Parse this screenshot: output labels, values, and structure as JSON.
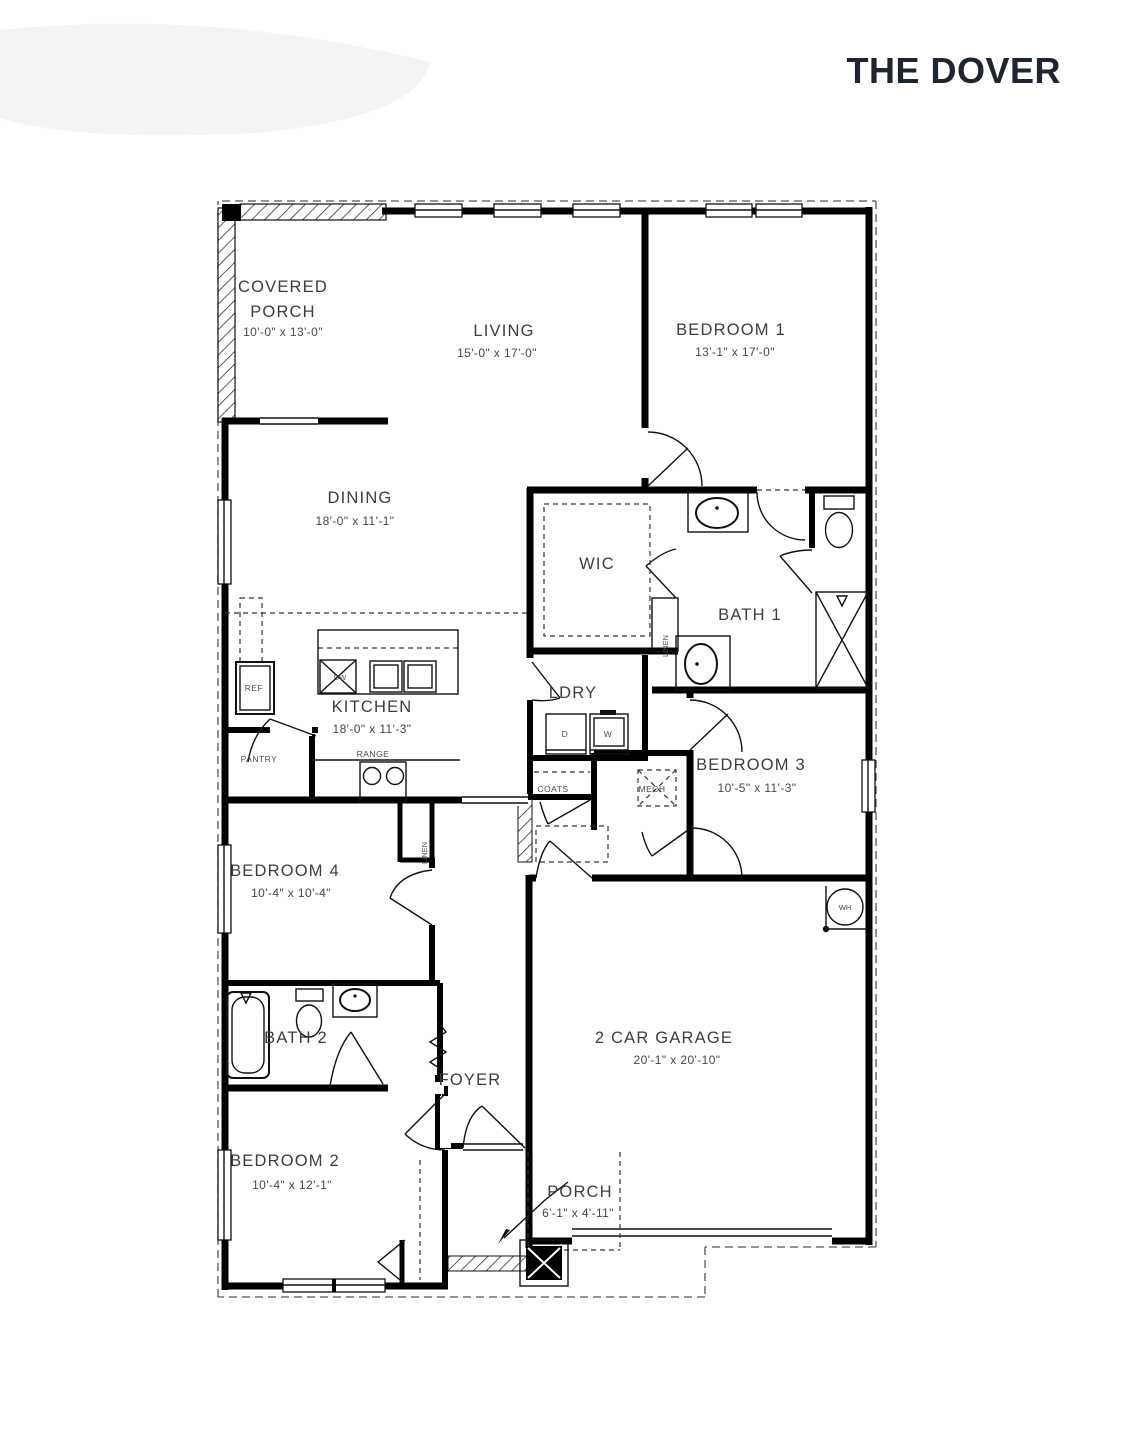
{
  "title": "THE DOVER",
  "rooms": {
    "covered_porch": {
      "line1": "COVERED",
      "line2": "PORCH",
      "dims": "10'-0\" x 13'-0\""
    },
    "living": {
      "label": "LIVING",
      "dims": "15'-0\" x 17'-0\""
    },
    "bedroom1": {
      "label": "BEDROOM 1",
      "dims": "13'-1\" x 17'-0\""
    },
    "dining": {
      "label": "DINING",
      "dims": "18'-0\" x 11'-1\""
    },
    "wic": {
      "label": "WIC"
    },
    "bath1": {
      "label": "BATH 1"
    },
    "kitchen": {
      "label": "KITCHEN",
      "dims": "18'-0\" x 11'-3\""
    },
    "ldry": {
      "label": "LDRY"
    },
    "bedroom3": {
      "label": "BEDROOM 3",
      "dims": "10'-5\" x 11'-3\""
    },
    "bedroom4": {
      "label": "BEDROOM 4",
      "dims": "10'-4\" x 10'-4\""
    },
    "bath2": {
      "label": "BATH 2"
    },
    "foyer": {
      "label": "FOYER"
    },
    "bedroom2": {
      "label": "BEDROOM 2",
      "dims": "10'-4\" x 12'-1\""
    },
    "garage": {
      "label": "2 CAR GARAGE",
      "dims": "20'-1\" x 20'-10\""
    },
    "porch": {
      "label": "PORCH",
      "dims": "6'-1\" x 4'-11\""
    }
  },
  "fixtures": {
    "ref": "REF",
    "pantry": "PANTRY",
    "range": "RANGE",
    "dw": "DW",
    "dryer": "D",
    "washer": "W",
    "coats": "COATS",
    "mech": "MECH",
    "linen_bath": "LINEN",
    "linen_hall": "LINEN",
    "water_heater": "WH"
  },
  "colors": {
    "wall": "#000000",
    "label": "#3d3d3d",
    "title": "#1e2430"
  }
}
